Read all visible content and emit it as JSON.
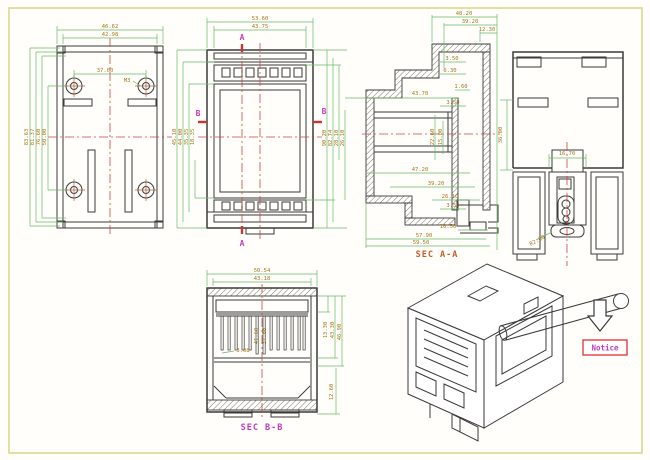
{
  "drawing_title": "DIN rail enclosure engineering drawing",
  "colors": {
    "page_border": "#d8d890",
    "geometry": "#3a3a3a",
    "dimension_line": "#69b869",
    "dimension_text": "#a5761f",
    "centerline": "#cc4444",
    "section_marker": "#c23ac2",
    "sec_aa_label": "#c55a2a",
    "sec_bb_label": "#c23ac2",
    "notice_border": "#e03030"
  },
  "bottom_view": {
    "top_dims": [
      "46.62",
      "42.98"
    ],
    "hole_span_dim": "37.00",
    "thread_label": "M3",
    "left_dims": [
      "83.63",
      "81.37",
      "76.60",
      "50.00"
    ]
  },
  "front_view": {
    "top_dims": [
      "53.60",
      "43.75"
    ],
    "left_dims": [
      "45.10",
      "44.00",
      "35.35",
      "18.35"
    ],
    "right_dims": [
      "90.20",
      "82.74",
      "28.10",
      "26.10"
    ],
    "marker_a": "A",
    "marker_b": "B"
  },
  "section_aa": {
    "label": "SEC A-A",
    "top_dims": [
      "48.20",
      "39.20",
      "12.30"
    ],
    "step_dims": [
      "3.50",
      "6.30",
      "1.60",
      "3.50"
    ],
    "depth_dim": "43.70",
    "mid_dims": [
      "22.60",
      "15.00"
    ],
    "bottom_dims": [
      "47.20",
      "39.20",
      "26.10",
      "3.50",
      "10.50",
      "57.90",
      "59.50"
    ]
  },
  "side_view": {
    "body_dim": "36.00",
    "clip_width_dim": "16.70",
    "radius_dim": "R2.00"
  },
  "section_bb": {
    "label": "SEC B-B",
    "top_dims": [
      "50.54",
      "43.18"
    ],
    "center_dims": [
      "41.60",
      "37.60"
    ],
    "pin_dim": "3.08",
    "right_dims": [
      "13.30",
      "43.30",
      "46.90"
    ],
    "bottom_right_dim": "12.60"
  },
  "iso_view": {
    "notice_label": "Notice"
  }
}
